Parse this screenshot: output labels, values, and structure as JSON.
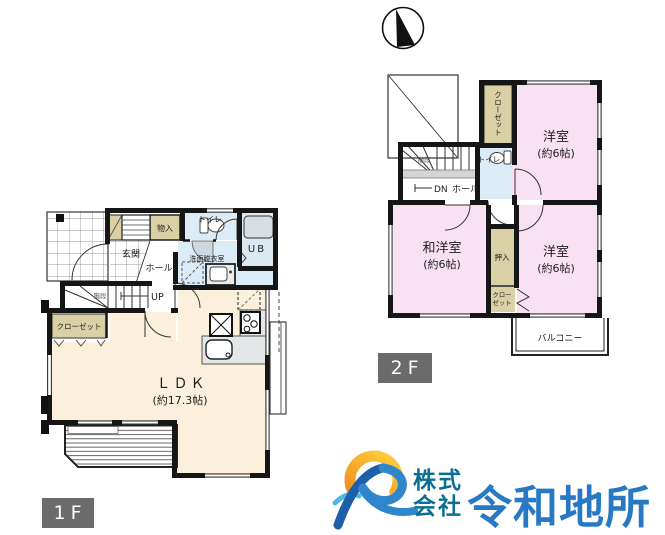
{
  "floor1": {
    "tag": "1F",
    "labels": {
      "monoire": "物入",
      "genkan": "玄関",
      "hall": "ホール",
      "toilet": "トイレ",
      "ub": "UB",
      "senmen": "洗面脱衣室",
      "kaidan": "階段",
      "up": "UP",
      "closet": "クローゼット",
      "ldk": "ＬＤＫ",
      "ldk_size": "(約17.3帖)"
    }
  },
  "floor2": {
    "tag": "2F",
    "labels": {
      "closet_top": "クローゼット",
      "kaidan": "階段",
      "dn": "DN",
      "hall": "ホール",
      "toilet": "トイレ",
      "yoshitsu_top": "洋室",
      "yoshitsu_top_size": "(約6帖)",
      "wayoshitsu": "和洋室",
      "wayoshitsu_size": "(約6帖)",
      "oshiire": "押入",
      "closet_small_1": "クロー",
      "closet_small_2": "ゼット",
      "yoshitsu_btm": "洋室",
      "yoshitsu_btm_size": "(約6帖)",
      "balcony": "バルコニー"
    }
  },
  "logo": {
    "corp_1": "株式",
    "corp_2": "会社",
    "name": "令和地所"
  },
  "colors": {
    "room_cream": "#faf0dc",
    "room_pink": "#f8e1f2",
    "closet_beige": "#d9d0a6",
    "water_blue": "#dcecf6",
    "ub_gray": "#dce8ef",
    "wall": "#161616",
    "tag_gray": "#6b6b6b",
    "logo_blue": "#2779c4",
    "logo_teal": "#0a6f92",
    "logo_orange": "#f5a41d"
  }
}
